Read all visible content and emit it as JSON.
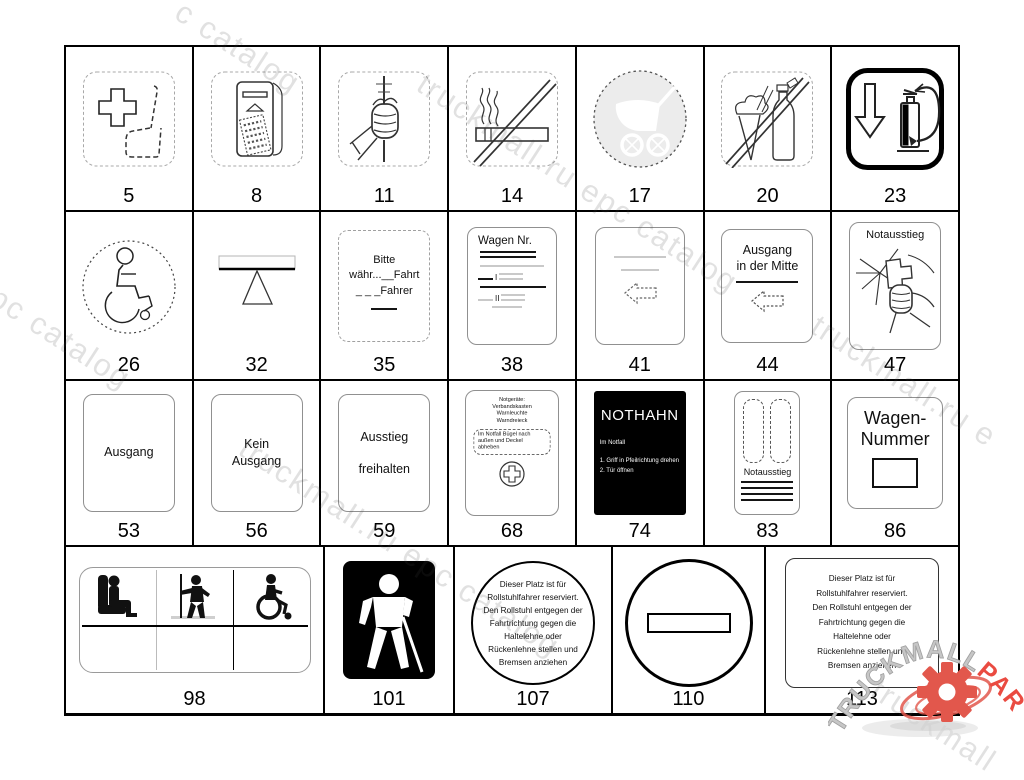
{
  "watermark": {
    "color": "rgba(70,70,70,0.16)",
    "items": [
      {
        "text": "c catalog"
      },
      {
        "text": "truckmall.ru epc catalog"
      },
      {
        "text": "l epc catalog"
      },
      {
        "text": "truckmall.ru epc catalog"
      },
      {
        "text": "truckmall.ru e"
      },
      {
        "text": "truckmall"
      }
    ]
  },
  "logo": {
    "brand": "TRUCKMALL",
    "suffix": "PARTS",
    "brand_color": "#c6c6c6",
    "suffix_color": "#ea4b41",
    "gear_color": "#e2574c"
  },
  "wheelchair_notice": [
    "Dieser Platz ist für",
    "Rollstuhlfahrer reserviert.",
    "Den Rollstuhl entgegen der",
    "Fahrtrichtung gegen die",
    "Haltelehne oder",
    "Rückenlehne stellen und",
    "Bremsen anziehen"
  ],
  "signs": {
    "s5": {
      "num": "5",
      "icon": "first-aid-seat-icon"
    },
    "s8": {
      "num": "8",
      "icon": "ticket-validator-icon"
    },
    "s11": {
      "num": "11",
      "icon": "handhold-pole-icon"
    },
    "s14": {
      "num": "14",
      "icon": "no-smoking-icon"
    },
    "s17": {
      "num": "17",
      "icon": "pram-icon"
    },
    "s20": {
      "num": "20",
      "icon": "no-food-drink-icon"
    },
    "s23": {
      "num": "23",
      "icon": "fire-extinguisher-icon"
    },
    "s26": {
      "num": "26",
      "icon": "wheelchair-icon"
    },
    "s32": {
      "num": "32",
      "icon": "balance-bar-icon"
    },
    "s35": {
      "num": "35",
      "l1": "Bitte",
      "l2": "währ...__Fahrt",
      "l3": "_ _ _Fahrer"
    },
    "s38": {
      "num": "38",
      "title": "Wagen Nr.",
      "r1": "I",
      "r2": "II"
    },
    "s41": {
      "num": "41",
      "icon": "arrow-left-icon"
    },
    "s44": {
      "num": "44",
      "l1": "Ausgang",
      "l2": "in der Mitte"
    },
    "s47": {
      "num": "47",
      "title": "Notausstieg",
      "icon": "break-glass-hand-icon"
    },
    "s53": {
      "num": "53",
      "l1": "Ausgang"
    },
    "s56": {
      "num": "56",
      "l1": "Kein",
      "l2": "Ausgang"
    },
    "s59": {
      "num": "59",
      "l1": "Ausstieg",
      "l2": "freihalten"
    },
    "s68": {
      "num": "68",
      "h1": "Notgeräte:",
      "h2": "Verbandskasten",
      "h3": "Warnleuchte",
      "h4": "Warndreieck",
      "b1": "Im Notfall Bügel nach",
      "b2": "außen und Deckel",
      "b3": "abheben",
      "icon": "first-aid-cross-icon"
    },
    "s74": {
      "num": "74",
      "title": "NOTHAHN",
      "sub": "Im Notfall",
      "step1": "1. Griff in Pfeilrichtung drehen",
      "step2": "2. Tür öffnen"
    },
    "s83": {
      "num": "83",
      "title": "Notausstieg",
      "icon": "emergency-window-icon"
    },
    "s86": {
      "num": "86",
      "l1": "Wagen-",
      "l2": "Nummer"
    },
    "s98": {
      "num": "98",
      "icon": "seated-standing-wheelchair-icons"
    },
    "s101": {
      "num": "101",
      "icon": "blind-person-icon"
    },
    "s107": {
      "num": "107"
    },
    "s110": {
      "num": "110",
      "icon": "no-entry-icon"
    },
    "s113": {
      "num": "113"
    }
  }
}
